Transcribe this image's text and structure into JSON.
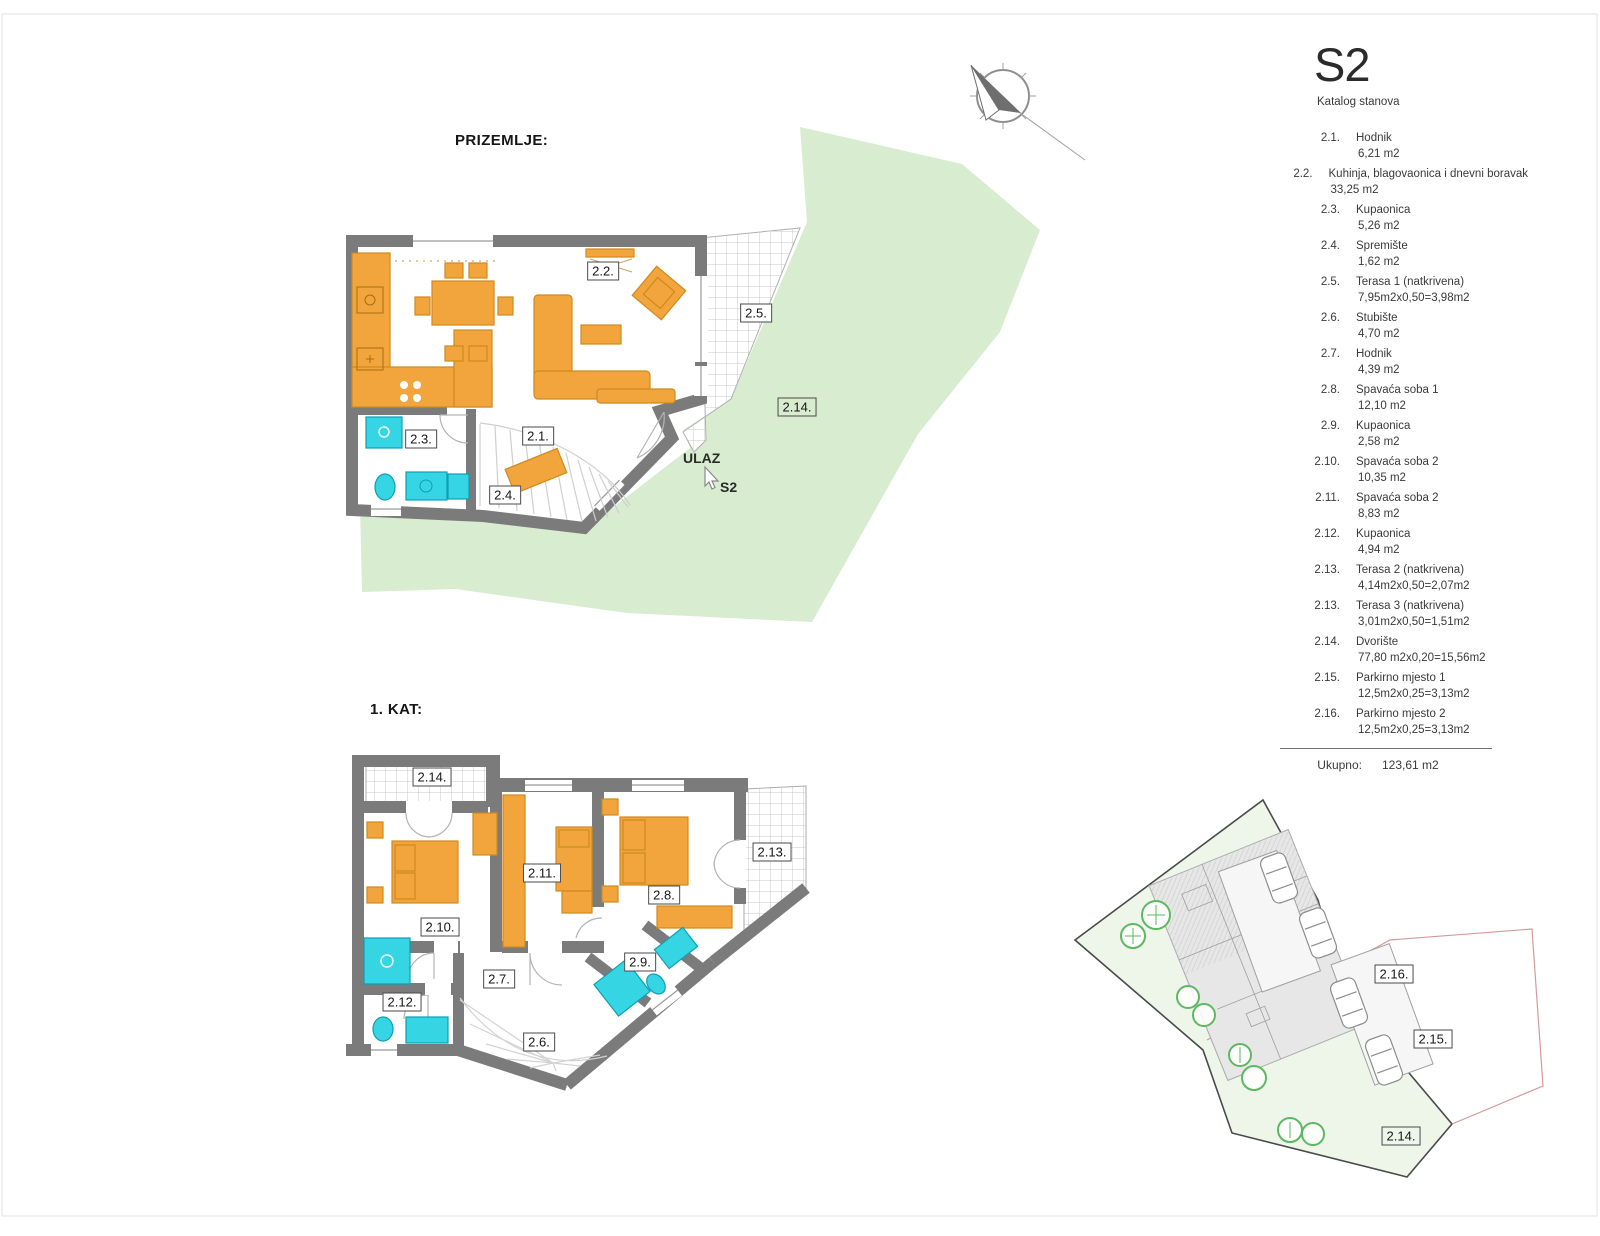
{
  "ground_floor": {
    "title": "PRIZEMLJE:",
    "room_labels": {
      "r2_1": "2.1.",
      "r2_2": "2.2.",
      "r2_3": "2.3.",
      "r2_4": "2.4.",
      "r2_5": "2.5.",
      "r2_14": "2.14."
    },
    "entrance": {
      "label": "ULAZ",
      "unit": "S2"
    }
  },
  "first_floor": {
    "title": "1. KAT:",
    "room_labels": {
      "r2_6": "2.6.",
      "r2_7": "2.7.",
      "r2_8": "2.8.",
      "r2_9": "2.9.",
      "r2_10": "2.10.",
      "r2_11": "2.11.",
      "r2_12": "2.12.",
      "r2_13": "2.13.",
      "r2_14": "2.14."
    }
  },
  "site_plan": {
    "labels": {
      "r2_14": "2.14.",
      "r2_15": "2.15.",
      "r2_16": "2.16."
    }
  },
  "legend": {
    "unit": "S2",
    "subtitle": "Katalog stanova",
    "items": [
      {
        "no": "2.1.",
        "name": "Hodnik",
        "area": "6,21 m2"
      },
      {
        "no": "2.2.",
        "name": "Kuhinja, blagovaonica i dnevni boravak",
        "area": "33,25 m2"
      },
      {
        "no": "2.3.",
        "name": "Kupaonica",
        "area": "5,26 m2"
      },
      {
        "no": "2.4.",
        "name": "Spremište",
        "area": "1,62 m2"
      },
      {
        "no": "2.5.",
        "name": "Terasa 1 (natkrivena)",
        "area": "7,95m2x0,50=3,98m2"
      },
      {
        "no": "2.6.",
        "name": "Stubište",
        "area": "4,70 m2"
      },
      {
        "no": "2.7.",
        "name": "Hodnik",
        "area": "4,39 m2"
      },
      {
        "no": "2.8.",
        "name": "Spavaća soba 1",
        "area": "12,10 m2"
      },
      {
        "no": "2.9.",
        "name": "Kupaonica",
        "area": "2,58 m2"
      },
      {
        "no": "2.10.",
        "name": "Spavaća soba 2",
        "area": "10,35 m2"
      },
      {
        "no": "2.11.",
        "name": "Spavaća soba 2",
        "area": "8,83 m2"
      },
      {
        "no": "2.12.",
        "name": "Kupaonica",
        "area": "4,94 m2"
      },
      {
        "no": "2.13.",
        "name": "Terasa 2 (natkrivena)",
        "area": "4,14m2x0,50=2,07m2"
      },
      {
        "no": "2.13.",
        "name": "Terasa 3 (natkrivena)",
        "area": "3,01m2x0,50=1,51m2"
      },
      {
        "no": "2.14.",
        "name": "Dvorište",
        "area": "77,80 m2x0,20=15,56m2"
      },
      {
        "no": "2.15.",
        "name": "Parkirno mjesto 1",
        "area": "12,5m2x0,25=3,13m2"
      },
      {
        "no": "2.16.",
        "name": "Parkirno mjesto 2",
        "area": "12,5m2x0,25=3,13m2"
      }
    ],
    "total_label": "Ukupno:",
    "total_value": "123,61 m2"
  },
  "colors": {
    "walls": "#7B7B7B",
    "furniture": "#F2A43D",
    "furniture_stroke": "#CF8A1C",
    "fixtures": "#35D5E3",
    "fixtures_stroke": "#0C9FB5",
    "yard_green": "#D8ECCF",
    "site_green": "#EDF6E9",
    "tree_green": "#5CB861"
  }
}
